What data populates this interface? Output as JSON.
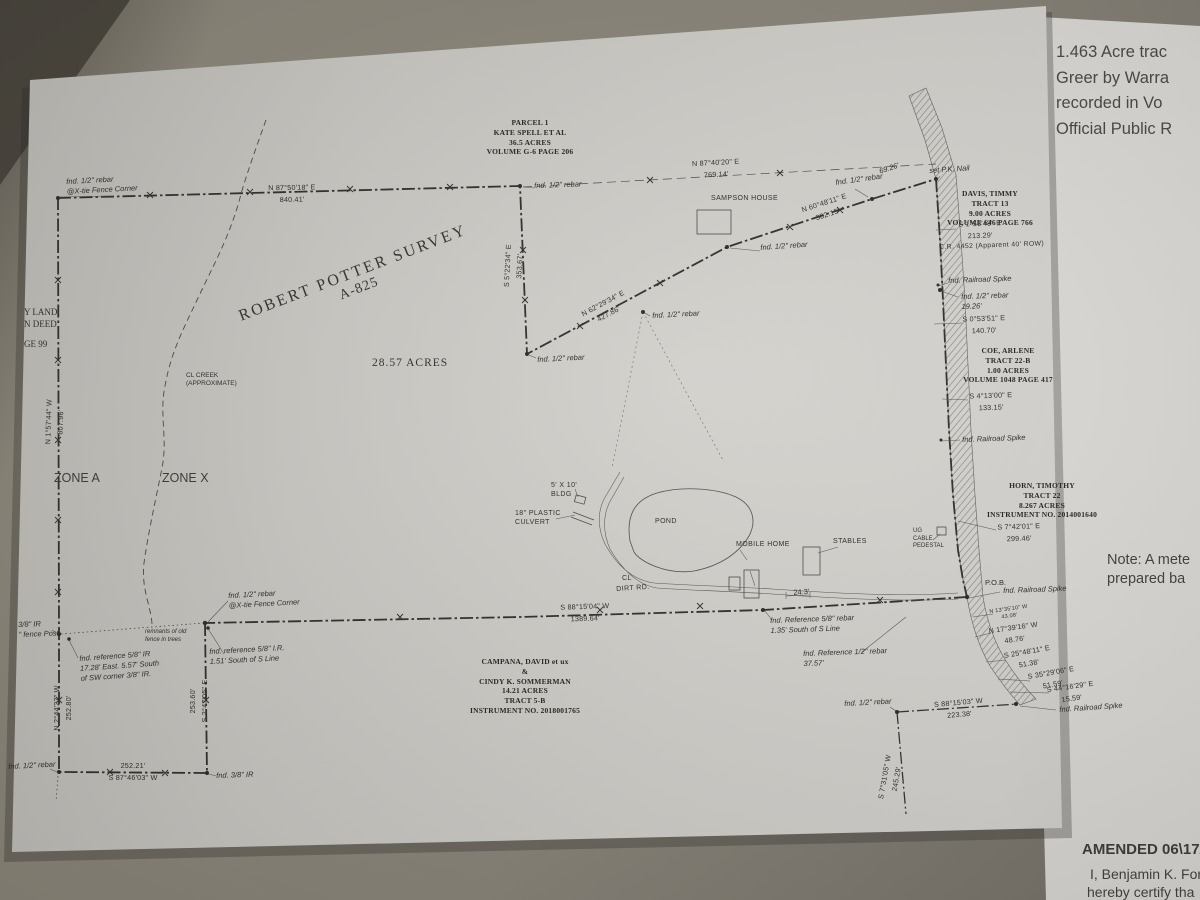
{
  "side_doc": {
    "line1": "1.463 Acre trac",
    "line2": "Greer by Warra",
    "line3": "recorded in Vo",
    "line4": "Official Public R",
    "note1": "Note: A mete",
    "note2": "prepared ba",
    "amended": "AMENDED 06\\17/20",
    "cert1": "I, Benjamin K. For",
    "cert2": "hereby certify tha"
  },
  "title": {
    "l1": "ROBERT POTTER SURVEY",
    "l2": "A-825"
  },
  "acreage": "28.57 ACRES",
  "zones": {
    "a": "ZONE A",
    "x": "ZONE X"
  },
  "parcels": {
    "kate": {
      "l1": "PARCEL 1",
      "l2": "KATE SPELL ET AL",
      "l3": "36.5 ACRES",
      "l4": "VOLUME G-6 PAGE 206"
    },
    "davis": {
      "l1": "DAVIS, TIMMY",
      "l2": "TRACT 13",
      "l3": "9.00 ACRES",
      "l4": "VOLUME 646 PAGE 766"
    },
    "coe": {
      "l1": "COE, ARLENE",
      "l2": "TRACT 22-B",
      "l3": "1.00 ACRES",
      "l4": "VOLUME 1048 PAGE 417"
    },
    "horn": {
      "l1": "HORN, TIMOTHY",
      "l2": "TRACT 22",
      "l3": "8.267 ACRES",
      "l4": "INSTRUMENT NO. 2014001640"
    },
    "campana": {
      "l1": "CAMPANA, DAVID et ux",
      "l2": "&",
      "l3": "CINDY K. SOMMERMAN",
      "l4": "14.21 ACRES",
      "l5": "TRACT 5-B",
      "l6": "INSTRUMENT NO. 2018001765"
    },
    "edge": {
      "l1": "Y LAND",
      "l2": "N DEED",
      "l3": "GE 99"
    }
  },
  "bearings": {
    "n875018": {
      "b": "N 87°50'18\" E",
      "d": "840.41'"
    },
    "n874020": {
      "b": "N 87°40'20\" E",
      "d": "769.14'"
    },
    "n622934": {
      "b": "N 62°29'34\" E",
      "d": "427.86'"
    },
    "n604811": {
      "b": "N 60°48'11\" E",
      "d": "382.15'"
    },
    "s52234": {
      "b": "S 5°22'34\" E",
      "d": "353.67'"
    },
    "n15744": {
      "b": "N 1°57'44\" W",
      "d": "807.96'"
    },
    "s881504": {
      "b": "S 88°15'04\" W",
      "d": "1389.64'"
    },
    "n24427": {
      "b": "N 2°44'27\" W",
      "d": "252.80'"
    },
    "s24705": {
      "b": "S 2°47'05\" E",
      "d": "253.60'"
    },
    "s874603": {
      "b": "S 87°46'03\" W",
      "d": "252.21'"
    },
    "s15343": {
      "b": "S 1°53'43\" E",
      "d": "213.29'"
    },
    "s05351": {
      "b": "S 0°53'51\" E",
      "d": "140.70'"
    },
    "s41300": {
      "b": "S 4°13'00\" E",
      "d": "133.15'"
    },
    "s74201": {
      "b": "S 7°42'01\" E",
      "d": "299.46'"
    },
    "n133510": {
      "b": "N 13°35'10\" W",
      "d": "43.08'"
    },
    "n173916": {
      "b": "N 17°39'16\" W",
      "d": "48.76'"
    },
    "s254811": {
      "b": "S 25°48'11\" E",
      "d": "51.38'"
    },
    "s352906": {
      "b": "S 35°29'06\" E",
      "d": "51.59'"
    },
    "s441629": {
      "b": "S 44°16'29\" E",
      "d": "15.59'"
    },
    "s881503": {
      "b": "S 88°15'03\" W",
      "d": "223.38'"
    },
    "s73105": {
      "b": "S 7°31'05\" W",
      "d": "245.29'"
    }
  },
  "marks": {
    "rebar12": "fnd. 1/2\" rebar",
    "xtie": "@X-tie Fence Corner",
    "pk": "set P.K. Nail",
    "spike": "fnd. Railroad Spike",
    "cr": "C.R. 4452   (Apparent 40' ROW)",
    "pob": "P.O.B.",
    "d6926": "69.26'",
    "d1926": "19.26'",
    "d243": "24.3'",
    "ref58a1": "fnd. Reference 5/8\" rebar",
    "ref58a2": "1.35' South of S Line",
    "ref12a1": "fnd. Reference 1/2\" rebar",
    "ref12a2": "37.57'",
    "refsw1": "fnd. reference 5/8\" IR",
    "refsw2": "17.28' East. 5.57' South",
    "refsw3": "of SW corner 3/8\" IR.",
    "refsl1": "fnd. reference 5/8\" I.R.",
    "refsl2": "1.51' South of S Line",
    "ir38": "3/8\" IR",
    "post": "\" fence Post",
    "rem1": "remnants of old",
    "rem2": "fence in trees",
    "fnd38": "fnd. 3/8\" IR"
  },
  "features": {
    "sampson": "SAMPSON HOUSE",
    "mobile": "MOBILE HOME",
    "stables": "STABLES",
    "pond": "POND",
    "bldg1": "5' X 10'",
    "bldg2": "BLDG",
    "culv1": "18\" PLASTIC",
    "culv2": "CULVERT",
    "ug1": "UG",
    "ug2": "CABLE",
    "ug3": "PEDESTAL",
    "cl": "CL",
    "dirt": "DIRT RD.",
    "creek1": "CL CREEK",
    "creek2": "(APPROXIMATE)"
  }
}
